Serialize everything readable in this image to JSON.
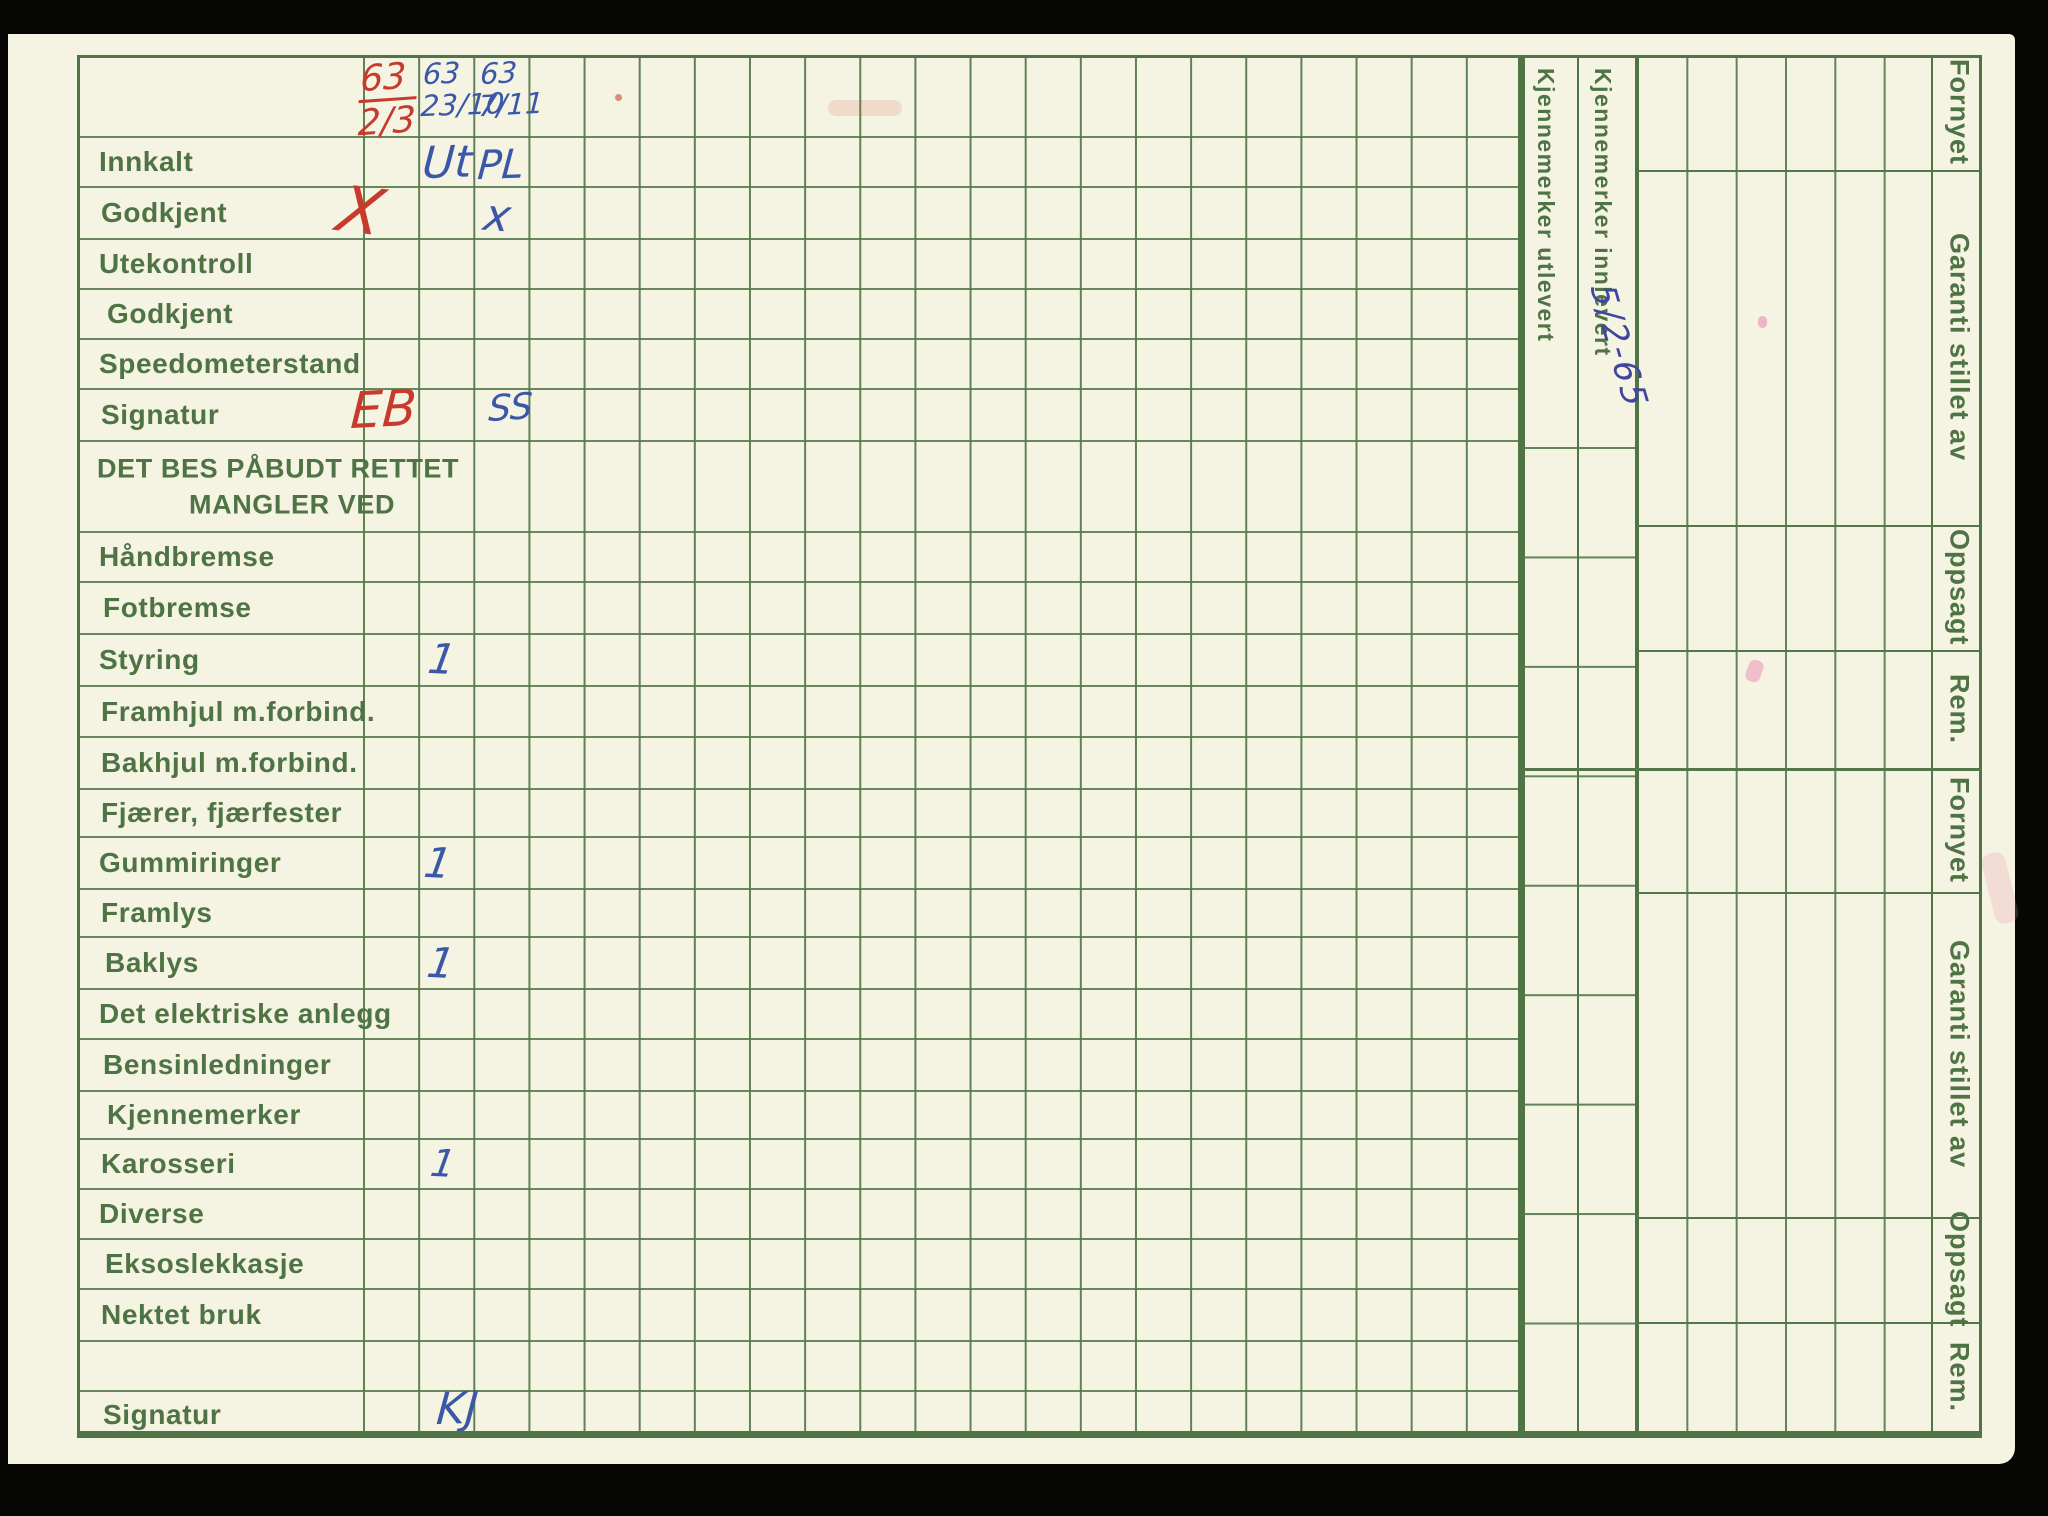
{
  "document": {
    "kind": "scanned vehicle inspection record card",
    "language": "Norwegian"
  },
  "main_table": {
    "rows": [
      {
        "label": ""
      },
      {
        "label": "Innkalt"
      },
      {
        "label": "Godkjent"
      },
      {
        "label": "Utekontroll"
      },
      {
        "label": "Godkjent"
      },
      {
        "label": "Speedometerstand"
      },
      {
        "label": "Signatur"
      },
      {
        "label": "DET BES PÅBUDT RETTET",
        "label2": "MANGLER VED"
      },
      {
        "label": "Håndbremse"
      },
      {
        "label": "Fotbremse"
      },
      {
        "label": "Styring"
      },
      {
        "label": "Framhjul m.forbind."
      },
      {
        "label": "Bakhjul m.forbind."
      },
      {
        "label": "Fjærer, fjærfester"
      },
      {
        "label": "Gummiringer"
      },
      {
        "label": "Framlys"
      },
      {
        "label": "Baklys"
      },
      {
        "label": "Det elektriske anlegg"
      },
      {
        "label": "Bensinledninger"
      },
      {
        "label": "Kjennemerker"
      },
      {
        "label": "Karosseri"
      },
      {
        "label": "Diverse"
      },
      {
        "label": "Eksoslekkasje"
      },
      {
        "label": "Nektet bruk"
      },
      {
        "label": ""
      },
      {
        "label": "Signatur"
      }
    ]
  },
  "right_panel": {
    "kjennemerker_utlevert": "Kjennemerker utlevert",
    "kjennemerker_innlevert": "Kjennemerker innlevert",
    "side_labels": [
      "Fornyet",
      "Garanti stillet av",
      "Oppsagt",
      "Rem.",
      "Fornyet",
      "Garanti stillet av",
      "Oppsagt",
      "Rem."
    ]
  },
  "annotations": {
    "col1_header": {
      "line1": "63",
      "line2": "2/3",
      "ink": "red"
    },
    "col2_header": {
      "line1": "63",
      "line2": "23/10",
      "ink": "blue"
    },
    "col3_header": {
      "line1": "63",
      "line2": "7/11",
      "ink": "blue"
    },
    "innkalt_col2": {
      "text": "Ut",
      "ink": "blue"
    },
    "innkalt_col3": {
      "text": "PL",
      "ink": "blue"
    },
    "godkjent_col1": {
      "text": "X",
      "ink": "red"
    },
    "godkjent_col3": {
      "text": "x",
      "ink": "blue"
    },
    "signatur_col1": {
      "text": "EB",
      "ink": "red"
    },
    "signatur_col3": {
      "text": "SS",
      "ink": "blue"
    },
    "styring_col2": {
      "text": "1",
      "ink": "blue"
    },
    "gummiringer_col2": {
      "text": "1",
      "ink": "blue"
    },
    "baklys_col2": {
      "text": "1",
      "ink": "blue"
    },
    "karosseri_col2": {
      "text": "1",
      "ink": "blue"
    },
    "signatur_bottom_col2": {
      "text": "KJ",
      "ink": "blue"
    },
    "innlevert_date": {
      "text": "5/2-65",
      "ink": "blue"
    }
  },
  "colors": {
    "paper": "#f5f3e2",
    "grid_green": "#53774a",
    "print_green": "#4e7345",
    "ink_red": "#c63b2c",
    "ink_blue": "#3a58a7",
    "ink_indigo": "#3f46a0",
    "background": "#060605"
  }
}
